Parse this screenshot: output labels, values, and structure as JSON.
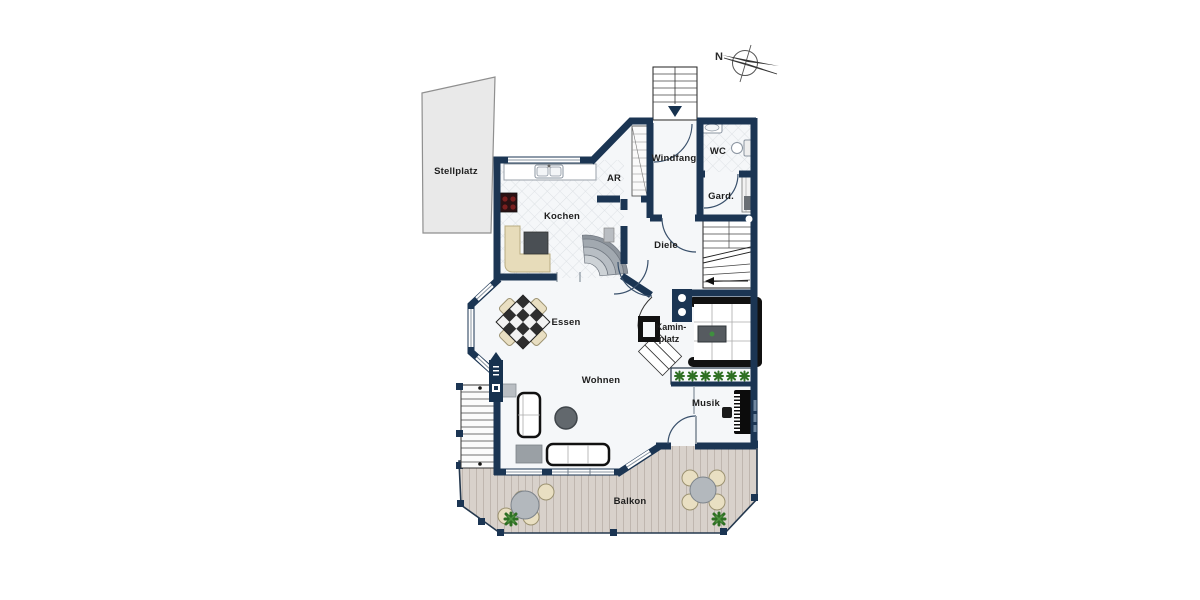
{
  "compass": {
    "label": "N"
  },
  "rooms": {
    "stellplatz": "Stellplatz",
    "kochen": "Kochen",
    "ar": "AR",
    "windfang": "Windfang",
    "wc": "WC",
    "gard": "Gard.",
    "diele": "Diele",
    "kamin_line1": "Kamin-",
    "kamin_line2": "platz",
    "essen": "Essen",
    "wohnen": "Wohnen",
    "musik": "Musik",
    "balkon": "Balkon"
  },
  "colors": {
    "wall": "#1b3553",
    "floor": "#f5f7f9",
    "tile_line": "#dde1e5",
    "deck": "#d8d1cb",
    "deck_line": "#bfb6af",
    "stellplatz_fill": "#e9e9e9",
    "stellplatz_border": "#8f8f8f",
    "bench": "#e7dcba",
    "chair": "#e9dfc2",
    "plant": "#2f7024",
    "step_gray": "#9aa1a8",
    "furniture_outline": "#111111"
  }
}
